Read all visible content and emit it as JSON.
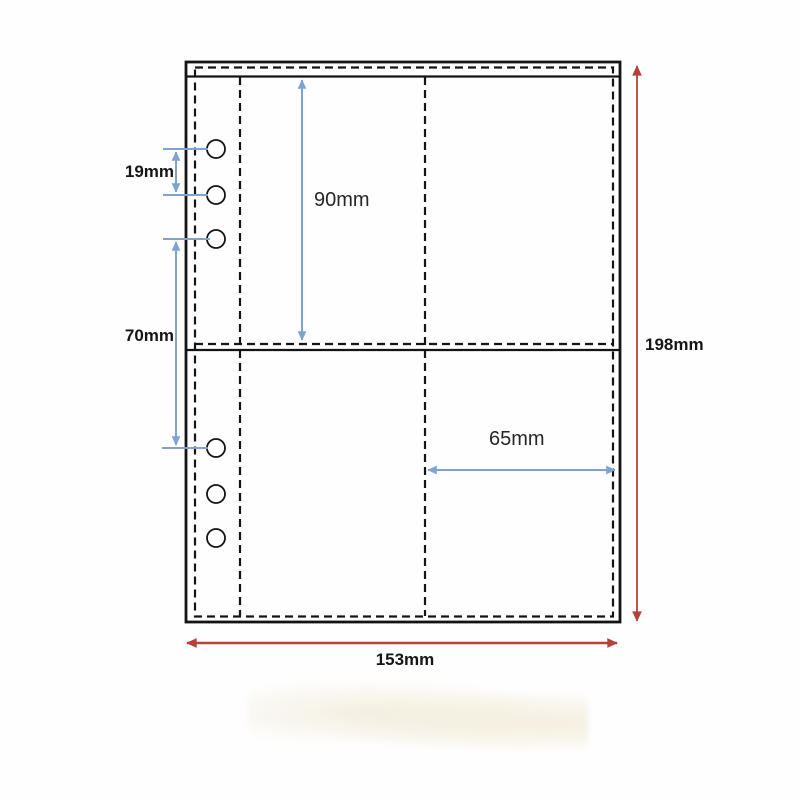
{
  "labels": {
    "hole_pitch": "19mm",
    "hole_group_gap": "70mm",
    "pocket_height": "90mm",
    "pocket_width": "65mm",
    "page_height": "198mm",
    "page_width": "153mm"
  },
  "page": {
    "hole_count": 6
  },
  "colors": {
    "dimension_blue": "#7fa3d1",
    "dimension_red": "#b5413c",
    "outline_black": "#141414",
    "background": "#fefefe"
  }
}
